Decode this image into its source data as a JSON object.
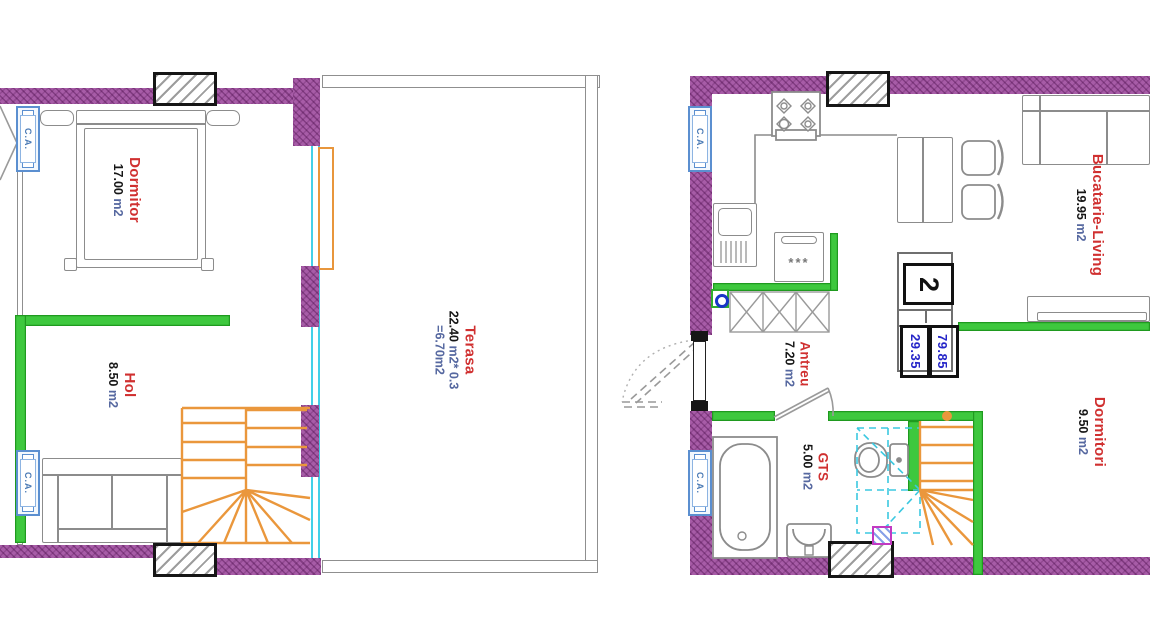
{
  "document": {
    "type": "apartment floor plan drawing",
    "sheets": "two levels of duplex apartment"
  },
  "left_plan": {
    "rooms": {
      "dormitor": {
        "name": "Dormitor",
        "area": "17.00",
        "unit": "m2"
      },
      "hol": {
        "name": "Hol",
        "area": "8.50",
        "unit": "m2"
      },
      "terasa": {
        "name": "Terasa",
        "area": "22.40",
        "unit_suffix": "m2* 0.3",
        "derived": "=6.70m2"
      }
    },
    "radiator_label": "C.A."
  },
  "right_plan": {
    "rooms": {
      "bucatarie": {
        "name": "Bucatarie-Living",
        "area": "19.95",
        "unit": "m2"
      },
      "antreu": {
        "name": "Antreu",
        "area": "7.20",
        "unit": "m2"
      },
      "gts": {
        "name": "GTS",
        "area": "5.00",
        "unit": "m2"
      },
      "dormitori": {
        "name": "Dormitori",
        "area": "9.50",
        "unit": "m2"
      }
    },
    "badge": {
      "apartment_number": "2",
      "area_total": "79.85",
      "area_secondary": "29.35"
    },
    "appliance_marks": "***",
    "radiator_label": "C.A."
  },
  "colors": {
    "wall_purple": "#a75ca7",
    "wall_green": "#3ec83e",
    "stairs_orange": "#ea973c",
    "glazing_cyan": "#43d0e8",
    "room_name_red": "#d03030",
    "area_unit_blue": "#5668a0",
    "badge_value_blue": "#2525c8",
    "radiator_blue": "#5b8fd0"
  }
}
